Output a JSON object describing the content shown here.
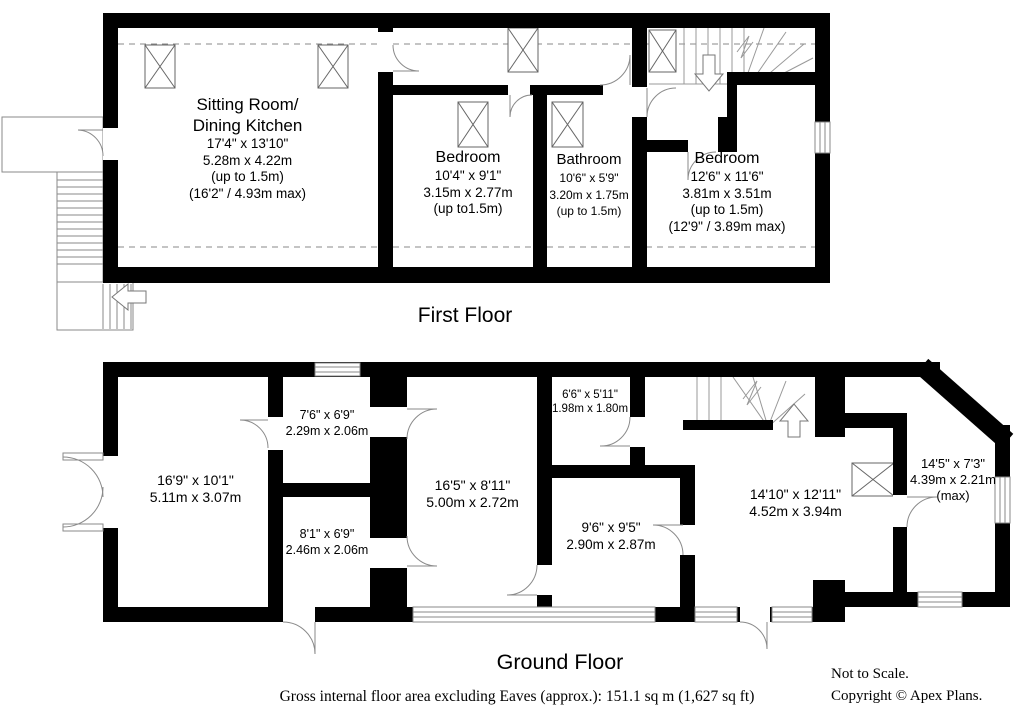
{
  "floors": {
    "first": {
      "label": "First Floor",
      "rooms": {
        "sitting": {
          "name_line1": "Sitting Room/",
          "name_line2": "Dining Kitchen",
          "dims": [
            "17'4\" x 13'10\"",
            "5.28m x 4.22m",
            "(up to 1.5m)",
            "(16'2\" / 4.93m max)"
          ]
        },
        "bedroom1": {
          "name": "Bedroom",
          "dims": [
            "10'4\" x 9'1\"",
            "3.15m x 2.77m",
            "(up to1.5m)"
          ]
        },
        "bathroom": {
          "name": "Bathroom",
          "dims": [
            "10'6\" x 5'9\"",
            "3.20m x 1.75m",
            "(up to 1.5m)"
          ]
        },
        "bedroom2": {
          "name": "Bedroom",
          "dims": [
            "12'6\" x 11'6\"",
            "3.81m x 3.51m",
            "(up to 1.5m)",
            "(12'9\" / 3.89m max)"
          ]
        }
      }
    },
    "ground": {
      "label": "Ground Floor",
      "rooms": {
        "room_169": {
          "dims": [
            "16'9\" x 10'1\"",
            "5.11m x 3.07m"
          ]
        },
        "room_76": {
          "dims": [
            "7'6\" x 6'9\"",
            "2.29m x 2.06m"
          ]
        },
        "room_81": {
          "dims": [
            "8'1\" x 6'9\"",
            "2.46m x 2.06m"
          ]
        },
        "room_165": {
          "dims": [
            "16'5\" x 8'11\"",
            "5.00m x 2.72m"
          ]
        },
        "room_66": {
          "dims": [
            "6'6\" x 5'11\"",
            "1.98m x 1.80m"
          ]
        },
        "room_96": {
          "dims": [
            "9'6\" x 9'5\"",
            "2.90m x 2.87m"
          ]
        },
        "room_1410": {
          "dims": [
            "14'10\" x 12'11\"",
            "4.52m x 3.94m"
          ]
        },
        "room_145": {
          "dims": [
            "14'5\" x 7'3\"",
            "4.39m x 2.21m",
            "(max)"
          ]
        }
      }
    }
  },
  "footer": {
    "area_note": "Gross internal floor area excluding Eaves (approx.): 151.1 sq m (1,627 sq ft)",
    "scale_note": "Not to Scale.",
    "copyright": "Copyright © Apex Plans."
  },
  "colors": {
    "wall": "#000000",
    "thin_line": "#8a8a8a",
    "background": "#ffffff"
  }
}
